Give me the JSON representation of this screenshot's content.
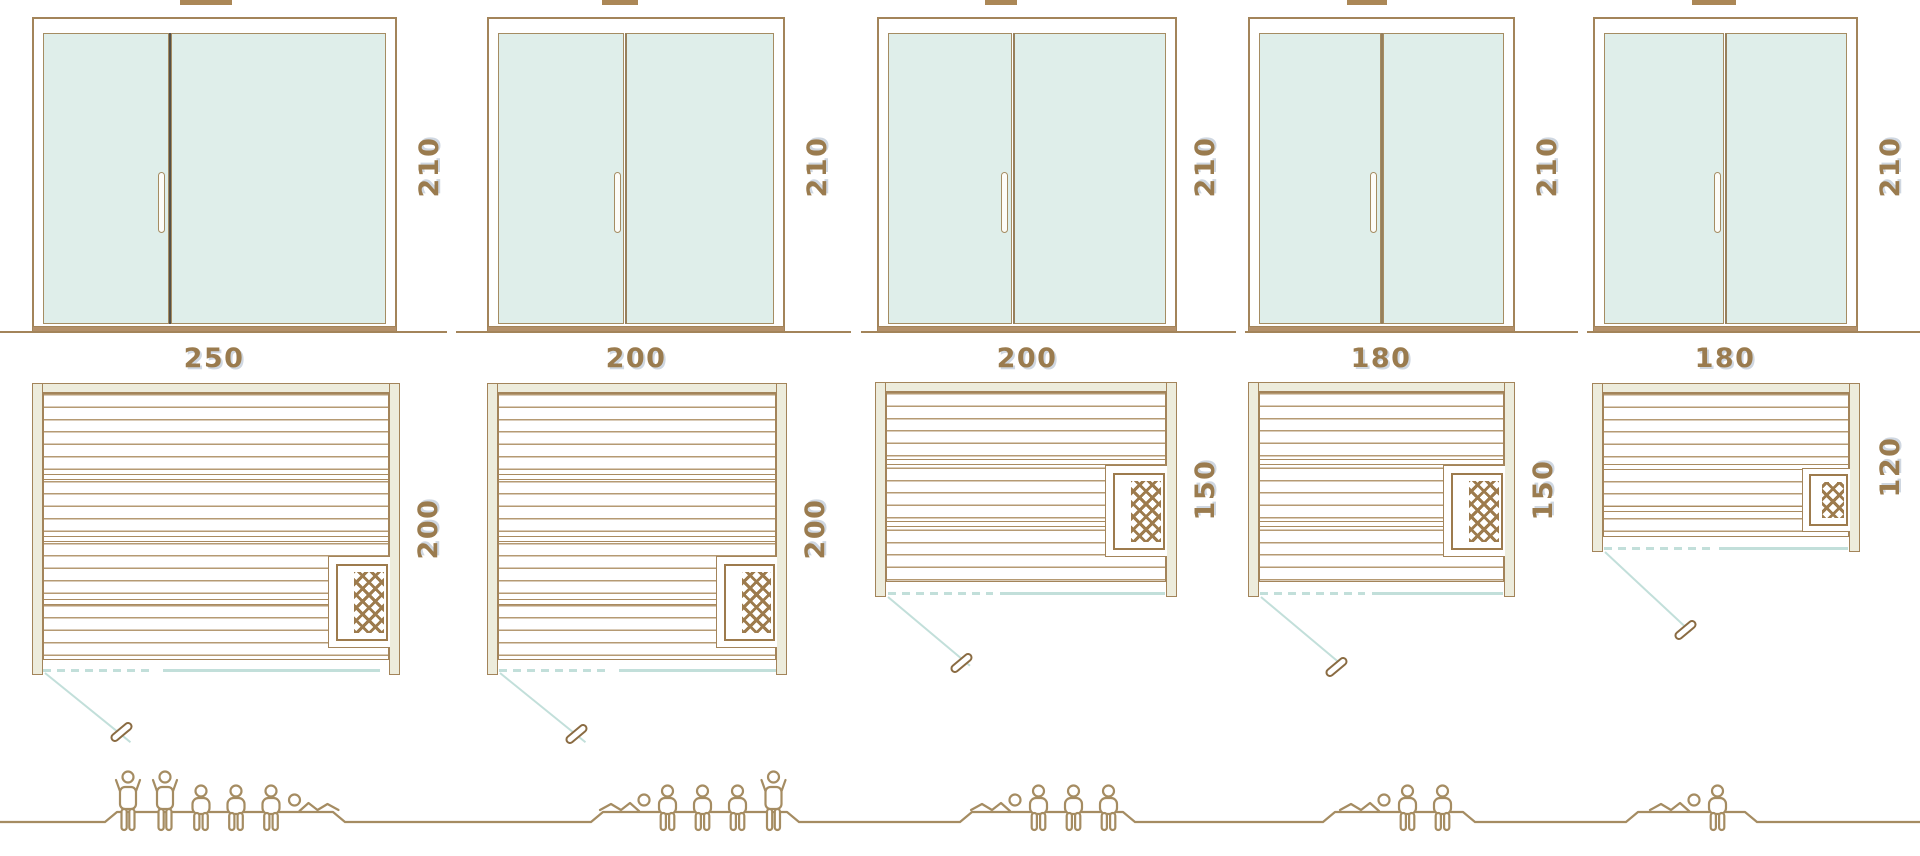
{
  "diagram": {
    "subject": "sauna size comparison drawing",
    "views": [
      "front elevation with double glass door",
      "floor plan with heater",
      "capacity figures"
    ],
    "units": "cm"
  },
  "colors": {
    "outline_tan": "#a3845a",
    "plank_line": "#b59a73",
    "glass_mint": "#dfeeea",
    "wood_fill_cream": "#edecdc",
    "heater_brown": "#9d7b4d",
    "swing_teal": "#c2dfda",
    "label_brown": "#9a7b4e",
    "people_tan": "#a58c62"
  },
  "saunas": [
    {
      "width": "250",
      "height": "210",
      "depth": "200",
      "capacity": 6,
      "poses": [
        "standing",
        "standing",
        "seated",
        "seated",
        "seated",
        "lying-right"
      ]
    },
    {
      "width": "200",
      "height": "210",
      "depth": "200",
      "capacity": 5,
      "poses": [
        "lying-left",
        "seated",
        "seated",
        "seated",
        "standing"
      ]
    },
    {
      "width": "200",
      "height": "210",
      "depth": "150",
      "capacity": 4,
      "poses": [
        "lying-left",
        "seated",
        "seated",
        "seated"
      ]
    },
    {
      "width": "180",
      "height": "210",
      "depth": "150",
      "capacity": 3,
      "poses": [
        "lying-left",
        "seated",
        "seated"
      ]
    },
    {
      "width": "180",
      "height": "210",
      "depth": "120",
      "capacity": 2,
      "poses": [
        "lying-left",
        "seated"
      ]
    }
  ]
}
